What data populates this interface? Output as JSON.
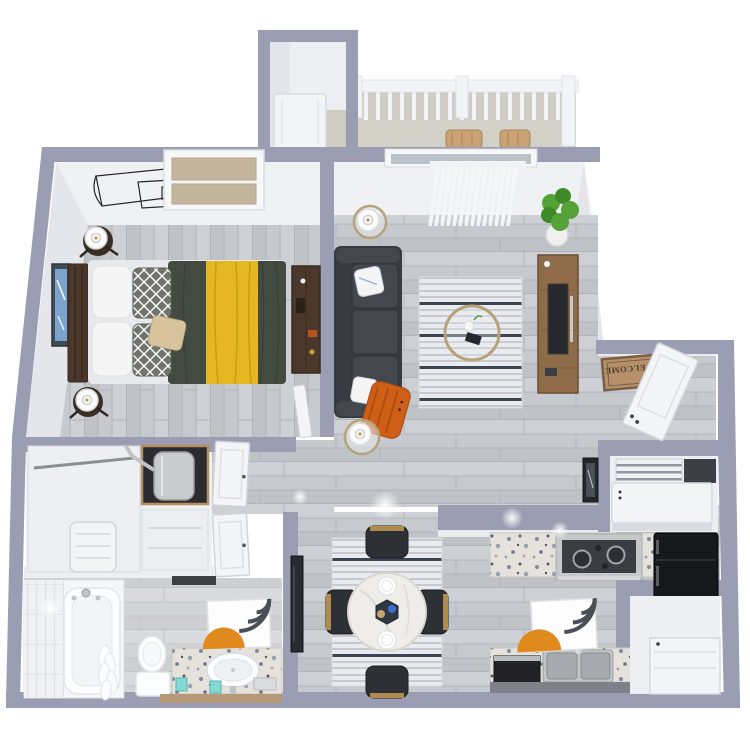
{
  "entry": {
    "mat_text": "WELCOME"
  },
  "colors": {
    "wall": "#9b9db2",
    "face_light": "#eff1f4",
    "face": "#e9ebef",
    "face_dim": "#e2e5ea",
    "face_side": "#e4e6eb",
    "wood_base": "#c6c9cd",
    "wood_line": "#b1b4b9",
    "wood_dark": "#bfc2c7",
    "wood_light": "#cdd0d4",
    "closet_floor": "#edeff2",
    "balcony_concrete": "#cfccc4",
    "rail_white": "#f3f4f7",
    "rug_base": "#eaebee",
    "rug_stripe": "#c5cad2",
    "rug_dark": "#3c4553",
    "sofa": "#383b41",
    "sofa_cushion": "#44474e",
    "pillow_white": "#f5f5f6",
    "pillow_pattern": "#70746a",
    "pillow_tan": "#d8c49c",
    "throw_orange": "#cf5f17",
    "duvet_green": "#434b41",
    "throw_yellow": "#e5b722",
    "wood_furniture": "#4b382a",
    "console_wood": "#8f6b4a",
    "tv_black": "#26282d",
    "plant_green": "#55a238",
    "plant_green_dark": "#3f8a28",
    "pot_white": "#f0f0ee",
    "gold": "#b7a379",
    "marble": "#efedea",
    "chair_dark": "#2d3035",
    "granite_base": "#e4e2db",
    "steel": "#c6c9cc",
    "cooktop_black": "#3a3d41",
    "appliance_black": "#17181c",
    "appliance_white": "#f3f4f6",
    "porcelain": "#fcfdfe",
    "tile_white": "#f0f1f3",
    "mat_tan": "#b5906b",
    "mat_border": "#7c5f42",
    "mat_text": "#503e2b",
    "art_orange": "#e0891c",
    "art_dark": "#4a4e55",
    "art_blue": "#7ba3cc",
    "blind_white": "#f6f7f9",
    "window_tan": "#c4b69e",
    "glass": "#b9c2c9",
    "door_white": "#f4f5f8",
    "teal": "#86d8d2",
    "wood_trim": "#b59877",
    "cabinet_gray": "#7e8188",
    "heater_silver": "#c9cbcf",
    "alcove_dark": "#2c2b2f",
    "line_art": "#26262a"
  }
}
